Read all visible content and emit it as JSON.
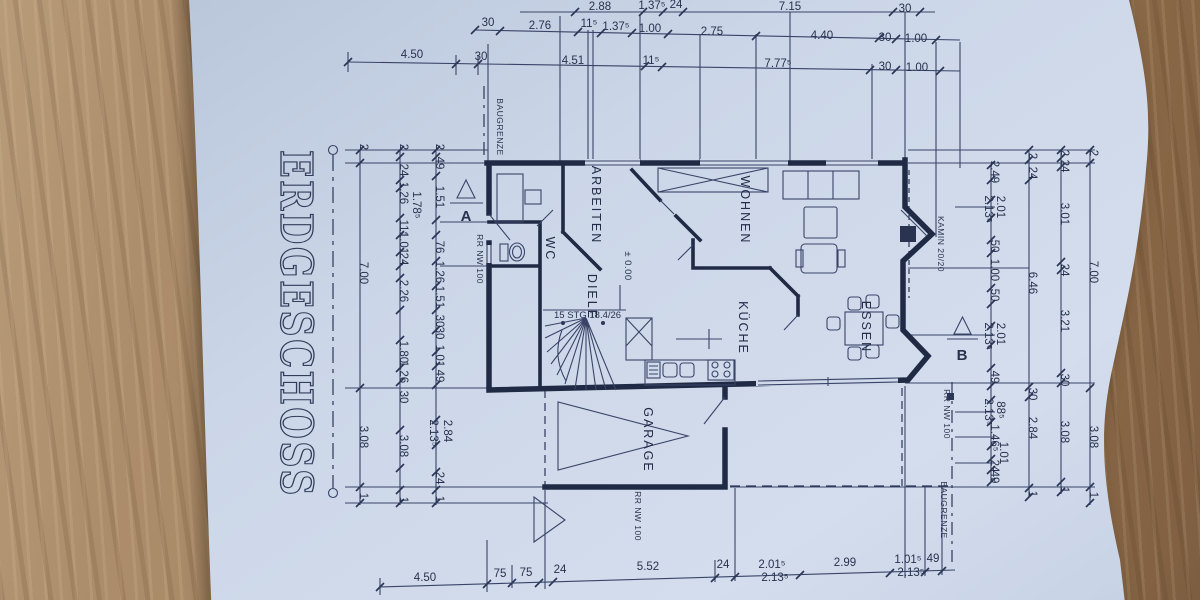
{
  "title": "ERDGESCHOSS",
  "rooms": {
    "arbeiten": "ARBEITEN",
    "wc": "WC",
    "diele": "DIELE",
    "wohnen": "WOHNEN",
    "kueche": "KÜCHE",
    "essen": "ESSEN",
    "garage": "GARAGE"
  },
  "annotations": {
    "baugrenze_top": "BAUGRENZE",
    "baugrenze_bottom": "BAUGRENZE",
    "kamin": "KAMIN 20/20",
    "rr_entry": "RR NW 100",
    "rr_right": "RR NW 100",
    "rr_garage": "RR NW 100",
    "stairs": "15 STG 18.4/26",
    "level": "± 0.00",
    "section_a": "A",
    "section_b": "B"
  },
  "dims": {
    "top1": [
      "2.88",
      "1.37⁵",
      "24",
      "7.15",
      "30"
    ],
    "top2": [
      "30",
      "2.76",
      "11⁵",
      "1.37⁵",
      "1.00",
      "2.75",
      "4.40",
      "30",
      "1.00"
    ],
    "top3": [
      "4.50",
      "30",
      "4.51",
      "11⁵",
      "7.77⁵",
      "30",
      "1.00"
    ],
    "bottom": [
      "4.50",
      "75",
      "75",
      "24",
      "5.52",
      "24",
      "2.01⁵",
      "2.13⁵",
      "2.99",
      "1.01⁵",
      "2.13⁵",
      "49"
    ],
    "left1": [
      "2",
      "49",
      "1.51",
      "76",
      "1.26",
      "1.51",
      "30",
      "30",
      "1.01",
      "49",
      "2.84",
      "2.13⁵",
      "24",
      "1"
    ],
    "left2": [
      "2",
      "24",
      "1.26",
      "1.78⁵",
      "11⁵",
      "1.01",
      "24",
      "2.26",
      "1.80",
      "1.26",
      "30",
      "3.08",
      "1"
    ],
    "left3": [
      "2",
      "7.00",
      "3.08",
      "1"
    ],
    "right1": [
      "2.49",
      "2.01",
      "2.13⁵",
      "50",
      "1.00",
      "50",
      "2.01",
      "2.13⁵",
      "49",
      "88⁵",
      "2.13⁵",
      "1.46⁵",
      "1.01",
      "24",
      "49"
    ],
    "right2": [
      "2",
      "24",
      "6.46",
      "30",
      "2.84",
      "1"
    ],
    "right3": [
      "2",
      "24",
      "3.01",
      "24",
      "3.21",
      "30",
      "3.08",
      "1"
    ],
    "right4": [
      "2",
      "7.00",
      "3.08",
      "1"
    ]
  }
}
